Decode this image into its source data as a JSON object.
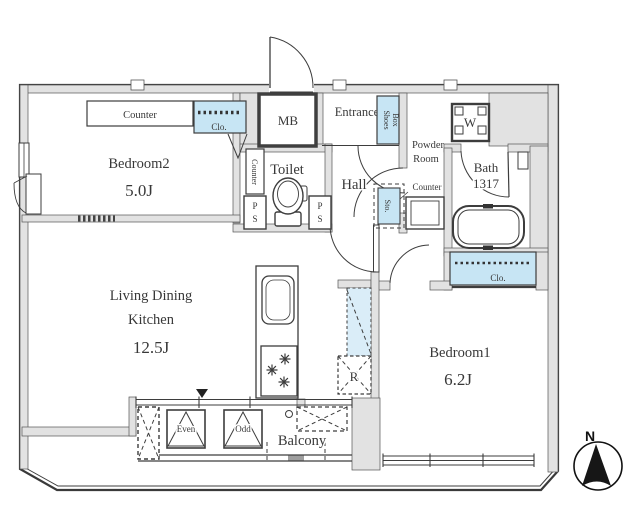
{
  "colors": {
    "wall": "#e2e2e2",
    "closet_blue": "#c7e5f4",
    "shelf_blue": "#daedf8"
  },
  "plan": {
    "bedroom2": {
      "label": "Bedroom2",
      "area": "5.0J",
      "counter_label": "Counter",
      "closet_label": "Clo."
    },
    "living_dining_kitchen": {
      "label_line1": "Living Dining",
      "label_line2": "Kitchen",
      "area": "12.5J",
      "fridge_label": "R"
    },
    "bedroom1": {
      "label": "Bedroom1",
      "area": "6.2J",
      "closet_label": "Clo."
    },
    "toilet": {
      "label": "Toilet",
      "counter_label": "Counter",
      "pipe_space_p": "P",
      "pipe_space_s": "S"
    },
    "hall": {
      "label": "Hall",
      "storage_label": "Sto."
    },
    "entrance": {
      "label": "Entrance",
      "shoes_box_line1": "Shoes",
      "shoes_box_line2": "Box",
      "meter_box_label": "MB"
    },
    "powder_room": {
      "label_line1": "Powder",
      "label_line2": "Room",
      "counter_label": "Counter",
      "washer_label": "W"
    },
    "bath": {
      "label": "Bath",
      "size_label": "1317"
    },
    "balcony": {
      "label": "Balcony",
      "ac_unit_even": "Even",
      "ac_unit_odd": "Odd"
    },
    "compass": {
      "north_label": "N"
    }
  }
}
